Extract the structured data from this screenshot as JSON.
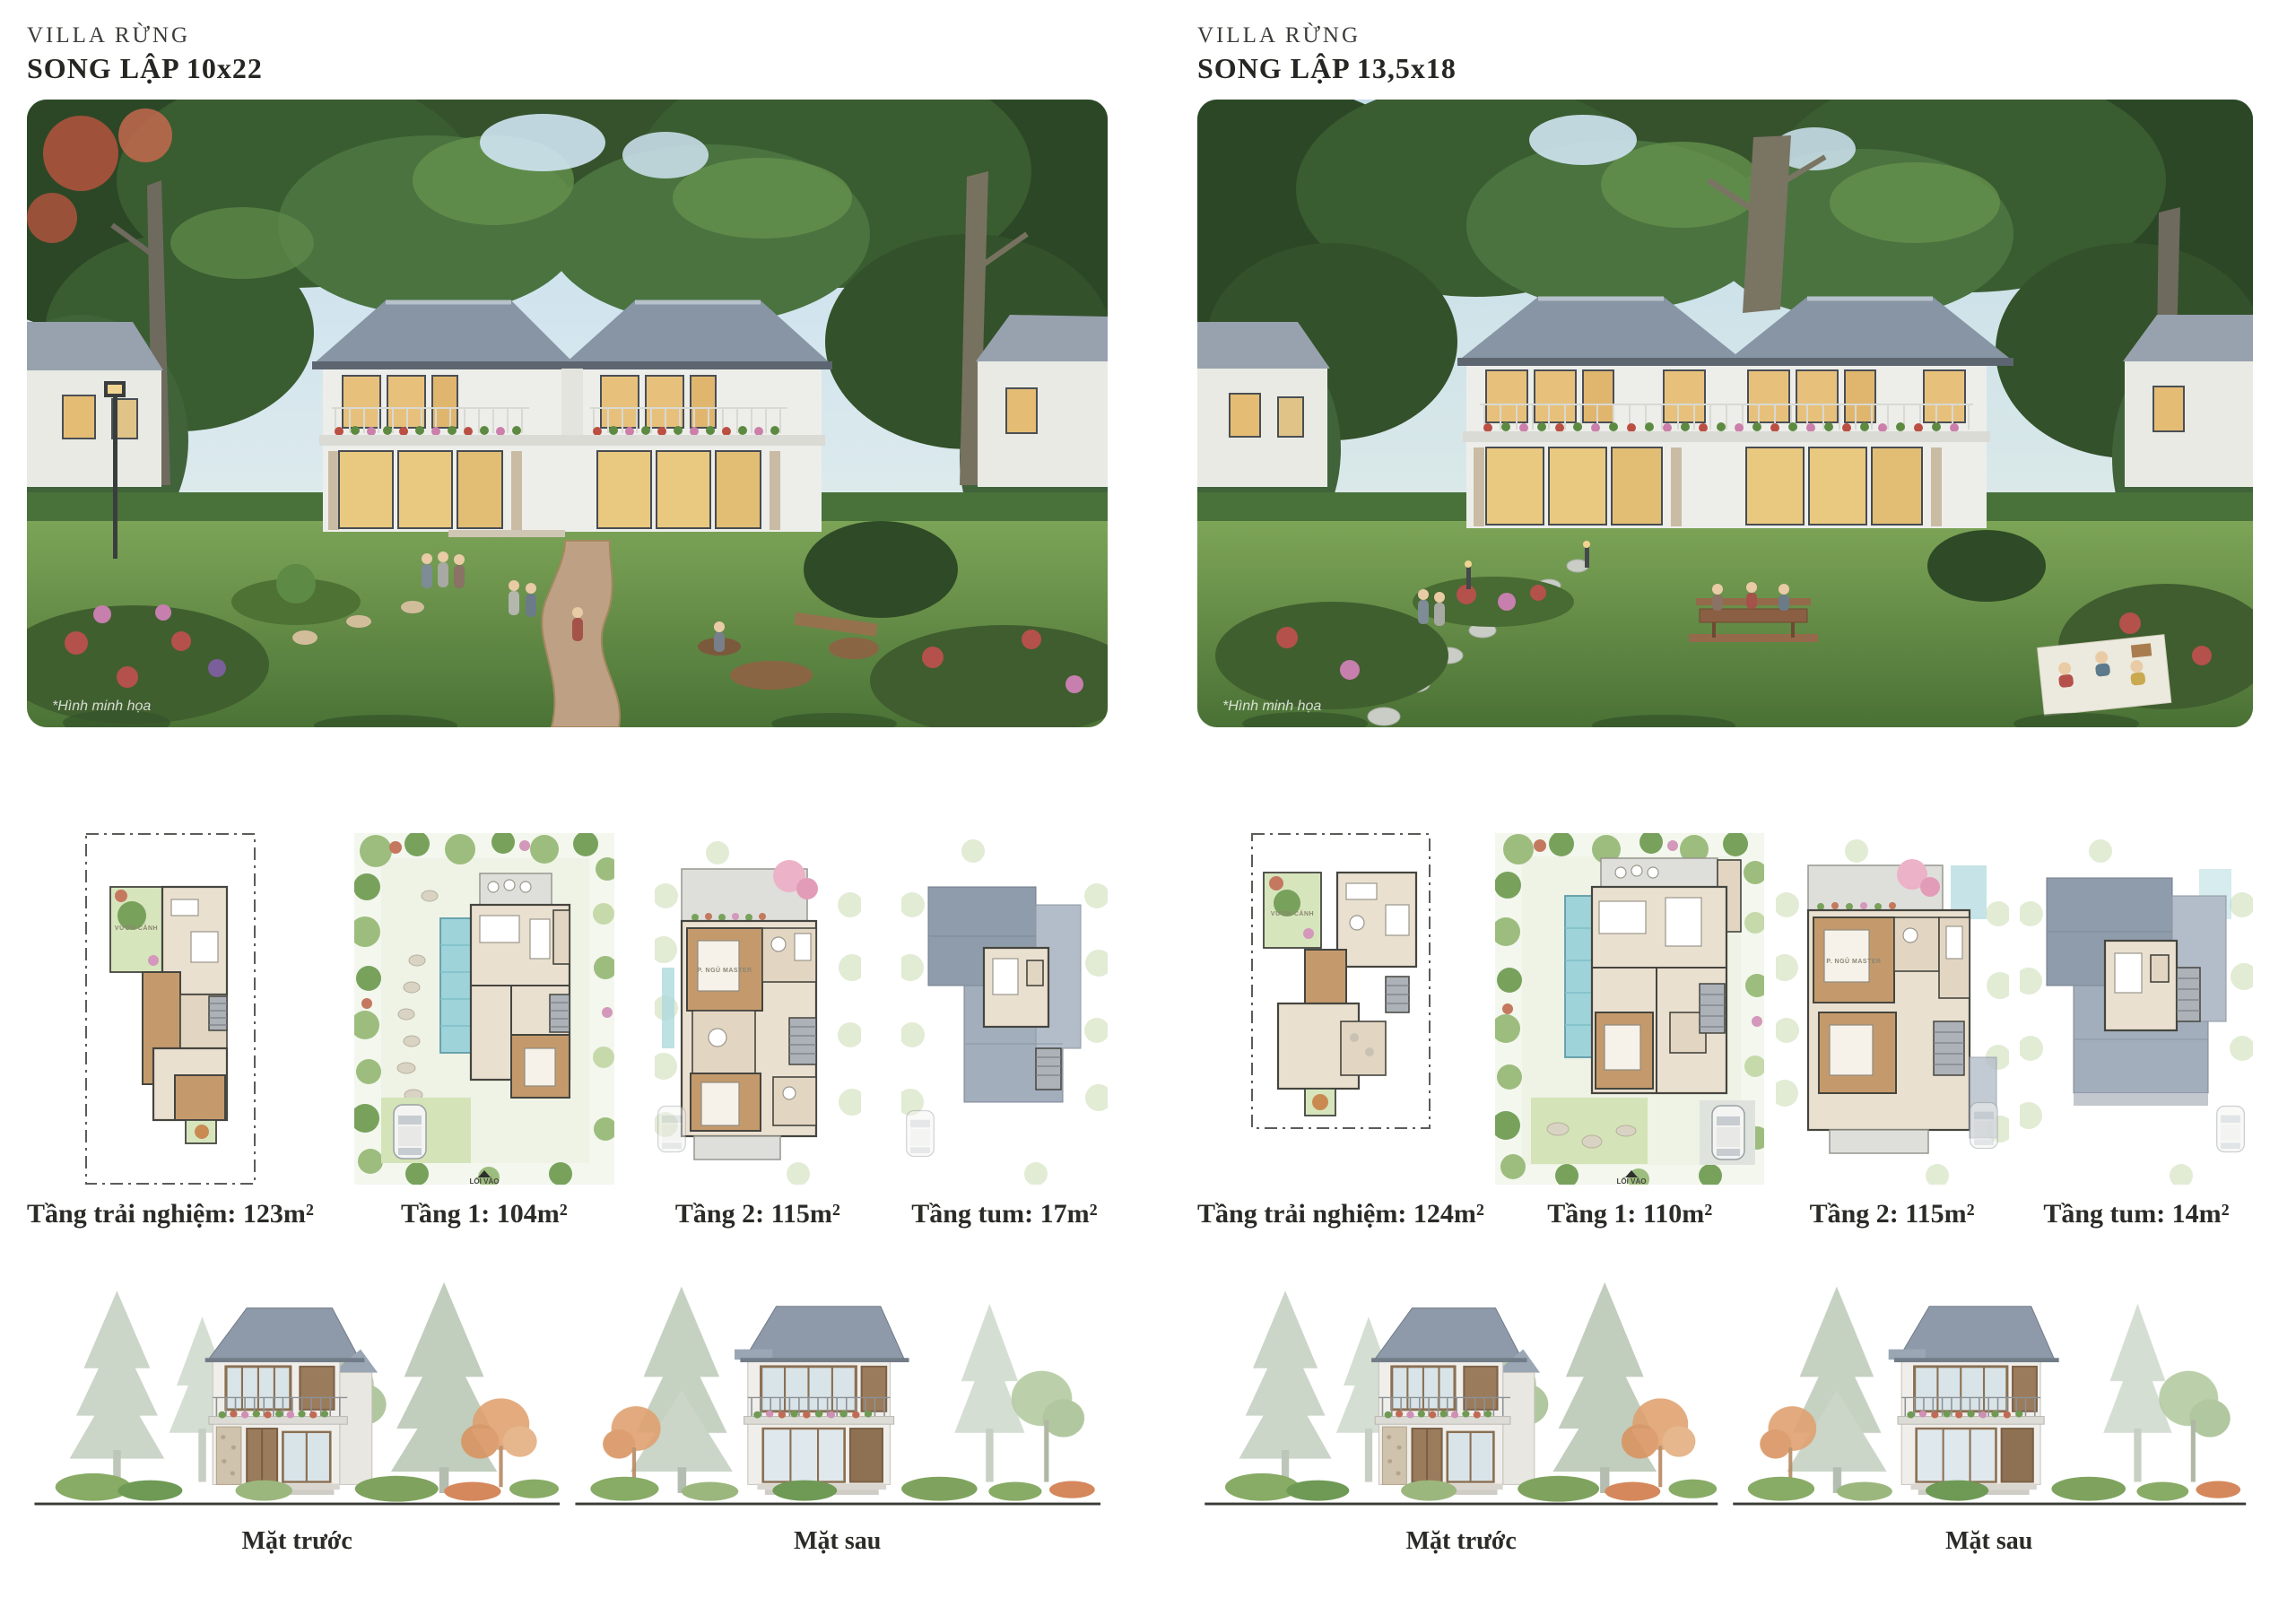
{
  "villas": {
    "left": {
      "subtitle": "VILLA RỪNG",
      "title": "SONG LẬP 10x22",
      "render_note": "*Hình minh họa",
      "plans": [
        {
          "label": "Tầng trải nghiệm: 123m²",
          "garden_label": "VƯỜN CẢNH"
        },
        {
          "label": "Tầng 1: 104m²",
          "entry_label": "LỐI VÀO"
        },
        {
          "label": "Tầng 2: 115m²",
          "room_label": "P. NGỦ MASTER"
        },
        {
          "label": "Tầng tum: 17m²"
        }
      ],
      "elevations": [
        {
          "label": "Mặt trước"
        },
        {
          "label": "Mặt sau"
        }
      ]
    },
    "right": {
      "subtitle": "VILLA RỪNG",
      "title": "SONG LẬP 13,5x18",
      "render_note": "*Hình minh họa",
      "plans": [
        {
          "label": "Tầng trải nghiệm: 124m²",
          "garden_label": "VƯỜN CẢNH"
        },
        {
          "label": "Tầng 1: 110m²",
          "entry_label": "LỐI VÀO"
        },
        {
          "label": "Tầng 2: 115m²",
          "room_label": "P. NGỦ MASTER"
        },
        {
          "label": "Tầng tum: 14m²"
        }
      ],
      "elevations": [
        {
          "label": "Mặt trước"
        },
        {
          "label": "Mặt sau"
        }
      ]
    }
  },
  "colors": {
    "page_background": "#ffffff",
    "heading_text": "#262622",
    "caption_text": "#2b2b27",
    "render_roof": "#8795a5",
    "render_lawn": "#6d9448",
    "render_canopy": "#3a5c31",
    "plan_wood": "#c49a6c",
    "plan_pool": "#9ed3d9",
    "plan_roof": "#8f9cab"
  }
}
